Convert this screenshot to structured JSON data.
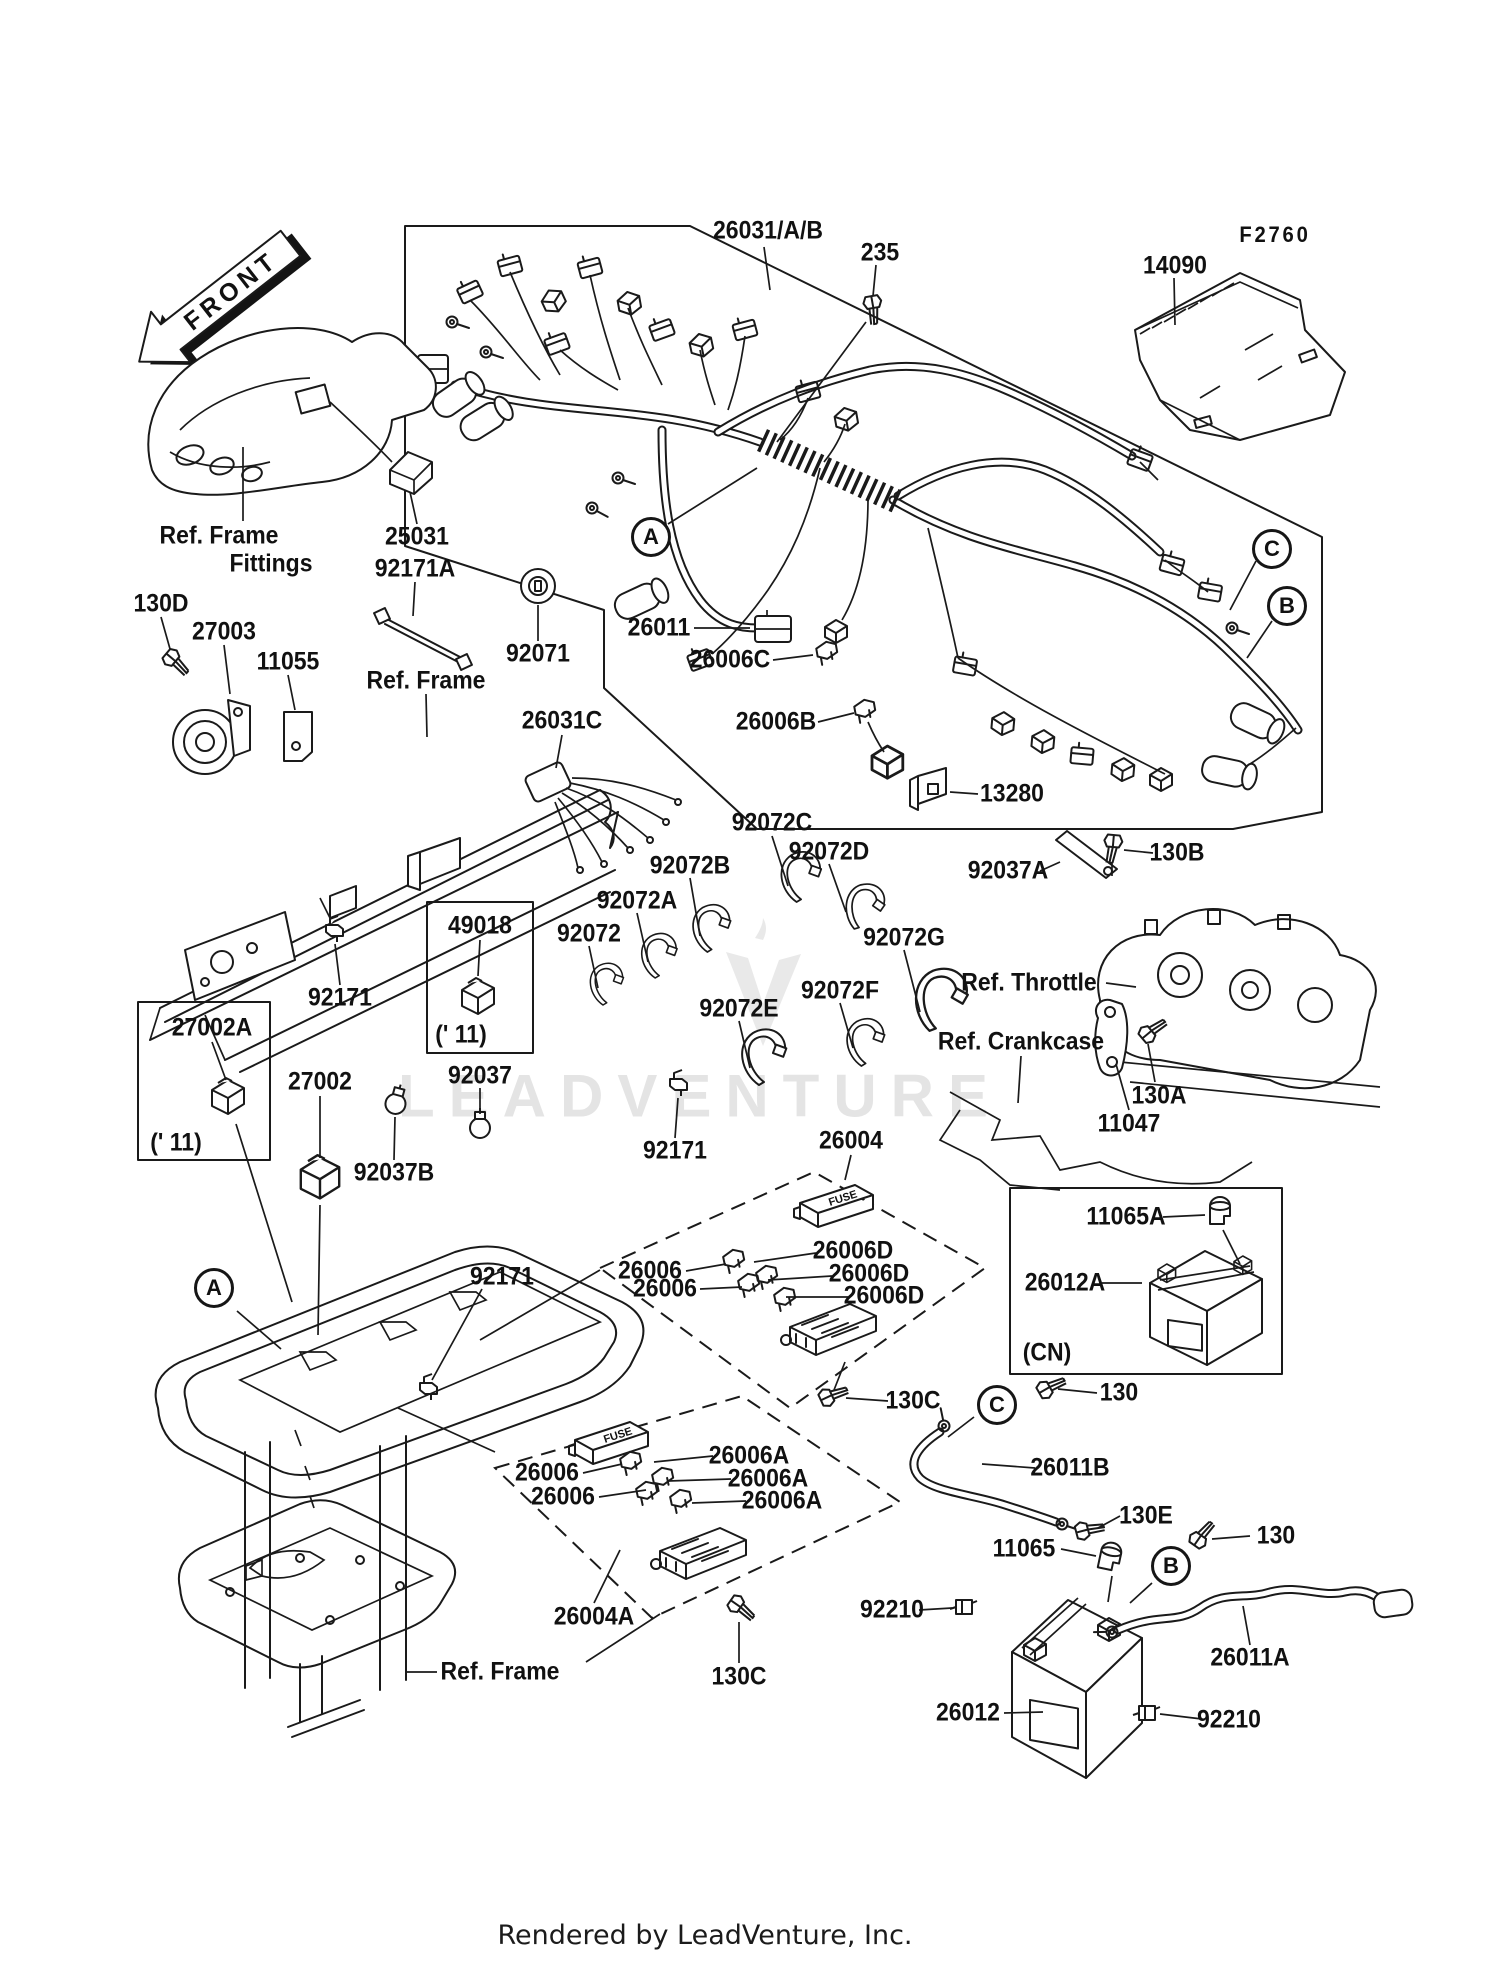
{
  "watermark": {
    "text": "LEADVENTURE"
  },
  "footer": {
    "credit": "Rendered by LeadVenture, Inc."
  },
  "diagram": {
    "front_label": "FRONT",
    "fuse_box_label": "FUSE",
    "line_color": "#1a1a1a",
    "watermark_color": "#e4e4e4",
    "labels": [
      {
        "text": "26031/A/B",
        "x": 768,
        "y": 231
      },
      {
        "text": "235",
        "x": 880,
        "y": 253
      },
      {
        "text": "F2760",
        "x": 1275,
        "y": 235,
        "fs": 22,
        "ls": 3
      },
      {
        "text": "14090",
        "x": 1175,
        "y": 266
      },
      {
        "text": "Ref. Frame",
        "x": 219,
        "y": 536
      },
      {
        "text": "Fittings",
        "x": 271,
        "y": 564
      },
      {
        "text": "25031",
        "x": 417,
        "y": 537
      },
      {
        "text": "92171A",
        "x": 415,
        "y": 569
      },
      {
        "text": "130D",
        "x": 161,
        "y": 604
      },
      {
        "text": "27003",
        "x": 224,
        "y": 632
      },
      {
        "text": "11055",
        "x": 288,
        "y": 662
      },
      {
        "text": "Ref. Frame",
        "x": 426,
        "y": 681
      },
      {
        "text": "92071",
        "x": 538,
        "y": 654
      },
      {
        "text": "26011",
        "x": 659,
        "y": 628
      },
      {
        "text": "26006C",
        "x": 730,
        "y": 660
      },
      {
        "text": "26031C",
        "x": 562,
        "y": 721
      },
      {
        "text": "26006B",
        "x": 776,
        "y": 722
      },
      {
        "text": "13280",
        "x": 1012,
        "y": 794
      },
      {
        "text": "92072C",
        "x": 772,
        "y": 823
      },
      {
        "text": "92072D",
        "x": 829,
        "y": 852
      },
      {
        "text": "92072B",
        "x": 690,
        "y": 866
      },
      {
        "text": "92037A",
        "x": 1008,
        "y": 871
      },
      {
        "text": "130B",
        "x": 1177,
        "y": 853
      },
      {
        "text": "92072A",
        "x": 637,
        "y": 901
      },
      {
        "text": "49018",
        "x": 480,
        "y": 926
      },
      {
        "text": "92072",
        "x": 589,
        "y": 934
      },
      {
        "text": "92072G",
        "x": 904,
        "y": 938
      },
      {
        "text": "Ref. Throttle",
        "x": 1029,
        "y": 983
      },
      {
        "text": "92072F",
        "x": 840,
        "y": 991
      },
      {
        "text": "92171",
        "x": 340,
        "y": 998
      },
      {
        "text": "92072E",
        "x": 739,
        "y": 1009
      },
      {
        "text": "(' 11)",
        "x": 461,
        "y": 1035
      },
      {
        "text": "27002A",
        "x": 212,
        "y": 1028
      },
      {
        "text": "Ref. Crankcase",
        "x": 1021,
        "y": 1042
      },
      {
        "text": "92037",
        "x": 480,
        "y": 1076
      },
      {
        "text": "27002",
        "x": 320,
        "y": 1082
      },
      {
        "text": "130A",
        "x": 1159,
        "y": 1096
      },
      {
        "text": "11047",
        "x": 1129,
        "y": 1124
      },
      {
        "text": "(' 11)",
        "x": 176,
        "y": 1143
      },
      {
        "text": "92171",
        "x": 675,
        "y": 1151
      },
      {
        "text": "26004",
        "x": 851,
        "y": 1141
      },
      {
        "text": "92037B",
        "x": 394,
        "y": 1173
      },
      {
        "text": "11065A",
        "x": 1126,
        "y": 1217
      },
      {
        "text": "26012A",
        "x": 1065,
        "y": 1283
      },
      {
        "text": "92171",
        "x": 502,
        "y": 1277
      },
      {
        "text": "26006",
        "x": 650,
        "y": 1271
      },
      {
        "text": "26006",
        "x": 665,
        "y": 1289
      },
      {
        "text": "26006D",
        "x": 853,
        "y": 1251
      },
      {
        "text": "26006D",
        "x": 869,
        "y": 1274
      },
      {
        "text": "26006D",
        "x": 884,
        "y": 1296
      },
      {
        "text": "(CN)",
        "x": 1047,
        "y": 1353
      },
      {
        "text": "130",
        "x": 1119,
        "y": 1393
      },
      {
        "text": "130C",
        "x": 913,
        "y": 1401
      },
      {
        "text": "26011B",
        "x": 1070,
        "y": 1468
      },
      {
        "text": "26006",
        "x": 547,
        "y": 1473
      },
      {
        "text": "26006",
        "x": 563,
        "y": 1497
      },
      {
        "text": "26006A",
        "x": 749,
        "y": 1456
      },
      {
        "text": "26006A",
        "x": 768,
        "y": 1479
      },
      {
        "text": "26006A",
        "x": 782,
        "y": 1501
      },
      {
        "text": "130E",
        "x": 1146,
        "y": 1516
      },
      {
        "text": "130",
        "x": 1276,
        "y": 1536
      },
      {
        "text": "11065",
        "x": 1024,
        "y": 1549
      },
      {
        "text": "92210",
        "x": 892,
        "y": 1610
      },
      {
        "text": "26004A",
        "x": 594,
        "y": 1617
      },
      {
        "text": "26011A",
        "x": 1250,
        "y": 1658
      },
      {
        "text": "Ref. Frame",
        "x": 500,
        "y": 1672
      },
      {
        "text": "130C",
        "x": 739,
        "y": 1677
      },
      {
        "text": "26012",
        "x": 968,
        "y": 1713
      },
      {
        "text": "92210",
        "x": 1229,
        "y": 1720
      }
    ],
    "callouts": [
      {
        "letter": "A",
        "x": 651,
        "y": 537
      },
      {
        "letter": "C",
        "x": 1272,
        "y": 549
      },
      {
        "letter": "B",
        "x": 1287,
        "y": 606
      },
      {
        "letter": "A",
        "x": 214,
        "y": 1288
      },
      {
        "letter": "C",
        "x": 997,
        "y": 1405
      },
      {
        "letter": "B",
        "x": 1171,
        "y": 1566
      }
    ]
  }
}
